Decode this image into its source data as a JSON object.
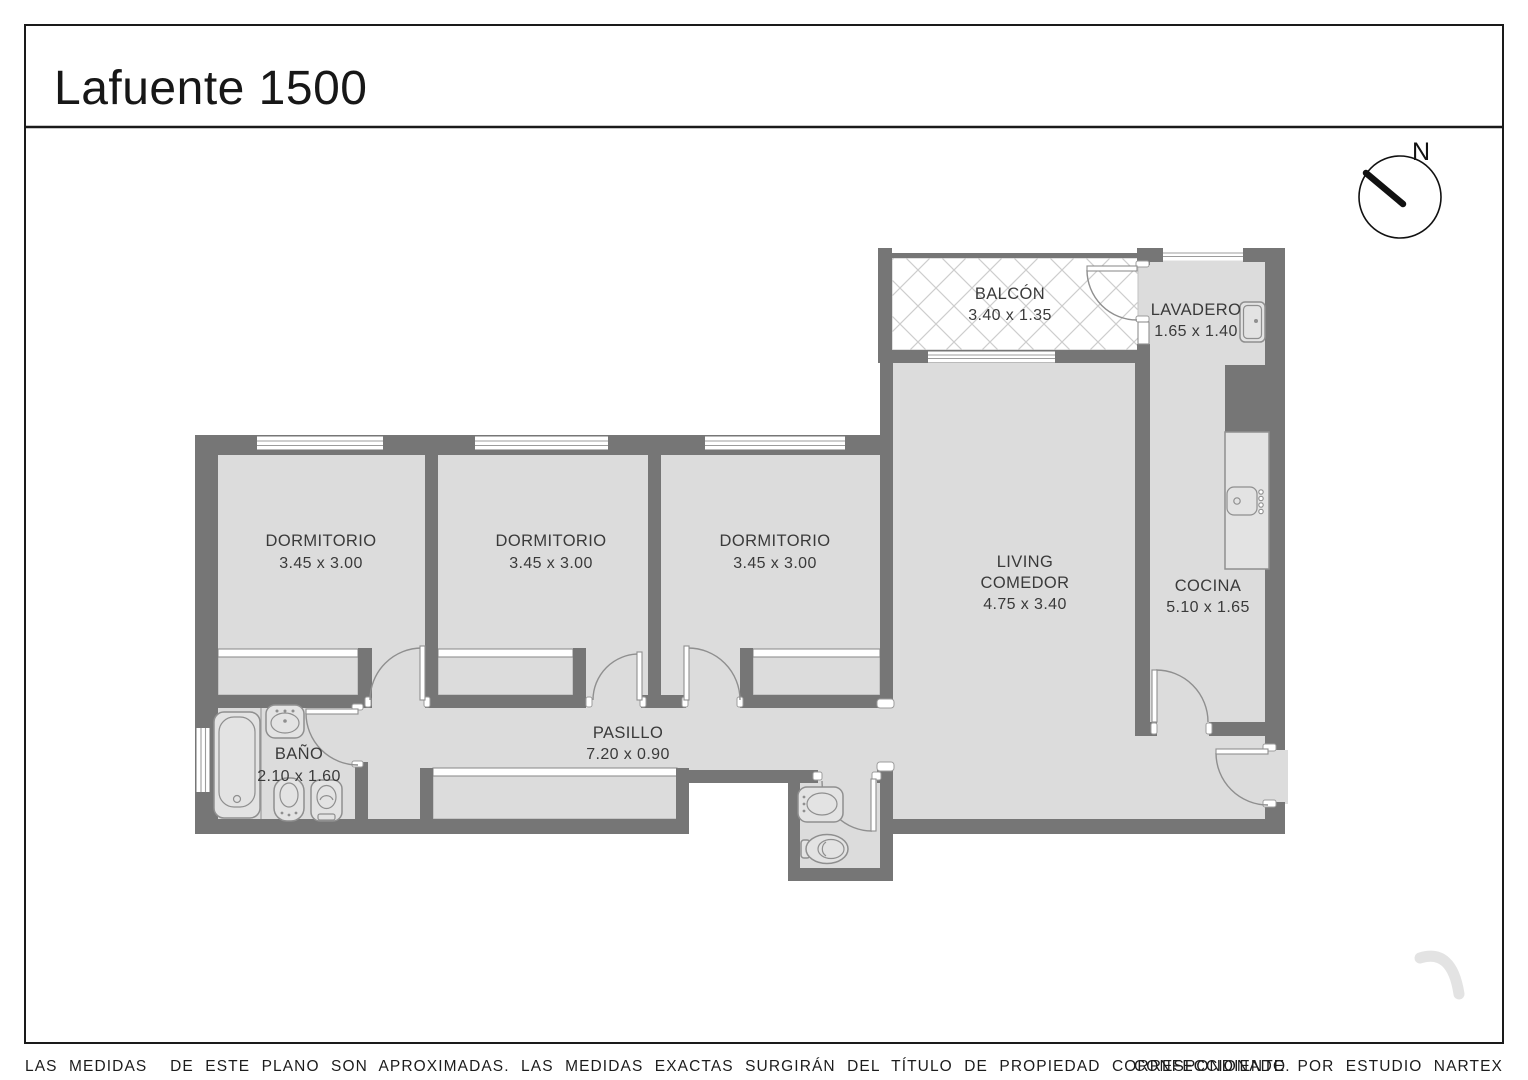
{
  "title": "Lafuente 1500",
  "compass": {
    "label": "N"
  },
  "rooms": [
    {
      "name": "BALCÓN",
      "dims": "3.40 x 1.35"
    },
    {
      "name": "LAVADERO",
      "dims": "1.65 x 1.40"
    },
    {
      "name": "DORMITORIO",
      "dims": "3.45 x 3.00"
    },
    {
      "name": "DORMITORIO",
      "dims": "3.45 x 3.00"
    },
    {
      "name": "DORMITORIO",
      "dims": "3.45 x 3.00"
    },
    {
      "name_line1": "LIVING",
      "name_line2": "COMEDOR",
      "dims": "4.75 x 3.40"
    },
    {
      "name": "COCINA",
      "dims": "5.10 x 1.65"
    },
    {
      "name": "BAÑO",
      "dims": "2.10 x 1.60"
    },
    {
      "name": "PASILLO",
      "dims": "7.20 x 0.90"
    }
  ],
  "footer": {
    "disclaimer": "LAS MEDIDAS  DE ESTE PLANO SON APROXIMADAS. LAS MEDIDAS EXACTAS SURGIRÁN DEL TÍTULO DE PROPIEDAD CORRESPONDIENTE.",
    "credit": "CONFECCIONADO POR ESTUDIO NARTEX"
  },
  "colors": {
    "wall": "#767676",
    "floor": "#dcdcdc",
    "accent_line": "#8f8f8f",
    "text": "#3a3a3a"
  }
}
